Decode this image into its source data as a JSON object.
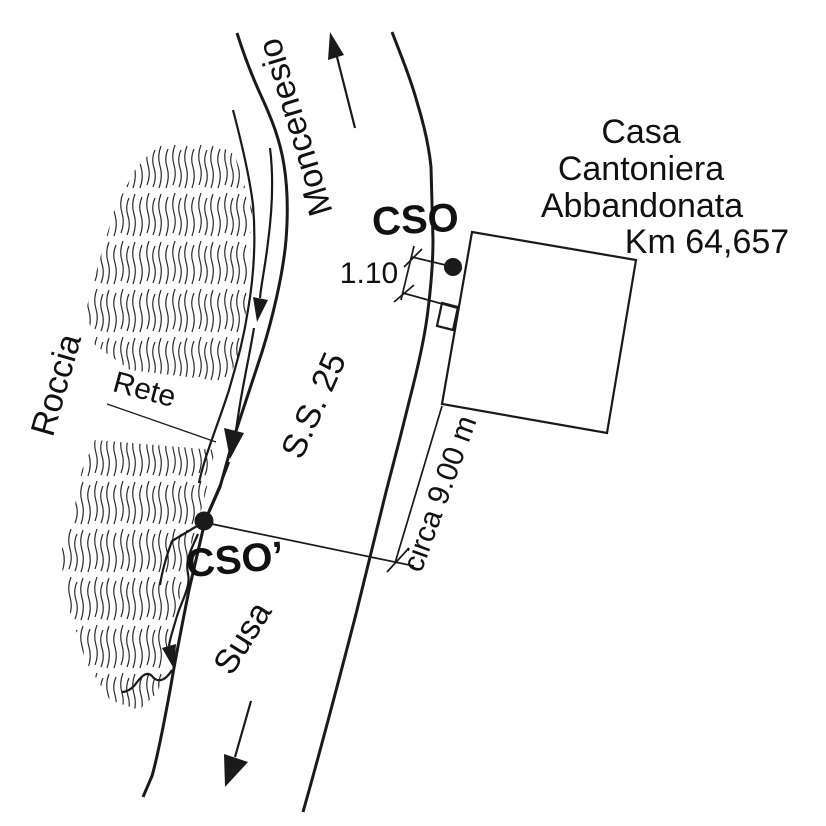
{
  "figure": {
    "kind": "site-location-sketch",
    "labels": {
      "direction_up": "Moncenesio",
      "road": "S.S. 25",
      "direction_down": "Susa",
      "rock": "Roccia",
      "net": "Rete",
      "station": "CSO",
      "station_prime": "CSO’",
      "dim_offset": "1.10",
      "dim_span": "circa 9.00 m",
      "building": [
        "Casa",
        "Cantoniera",
        "Abbandonata",
        "Km 64,657"
      ]
    },
    "colors": {
      "ink": "#1a1a1a",
      "building_fill": "#c8c8c8",
      "background": "#ffffff"
    }
  }
}
